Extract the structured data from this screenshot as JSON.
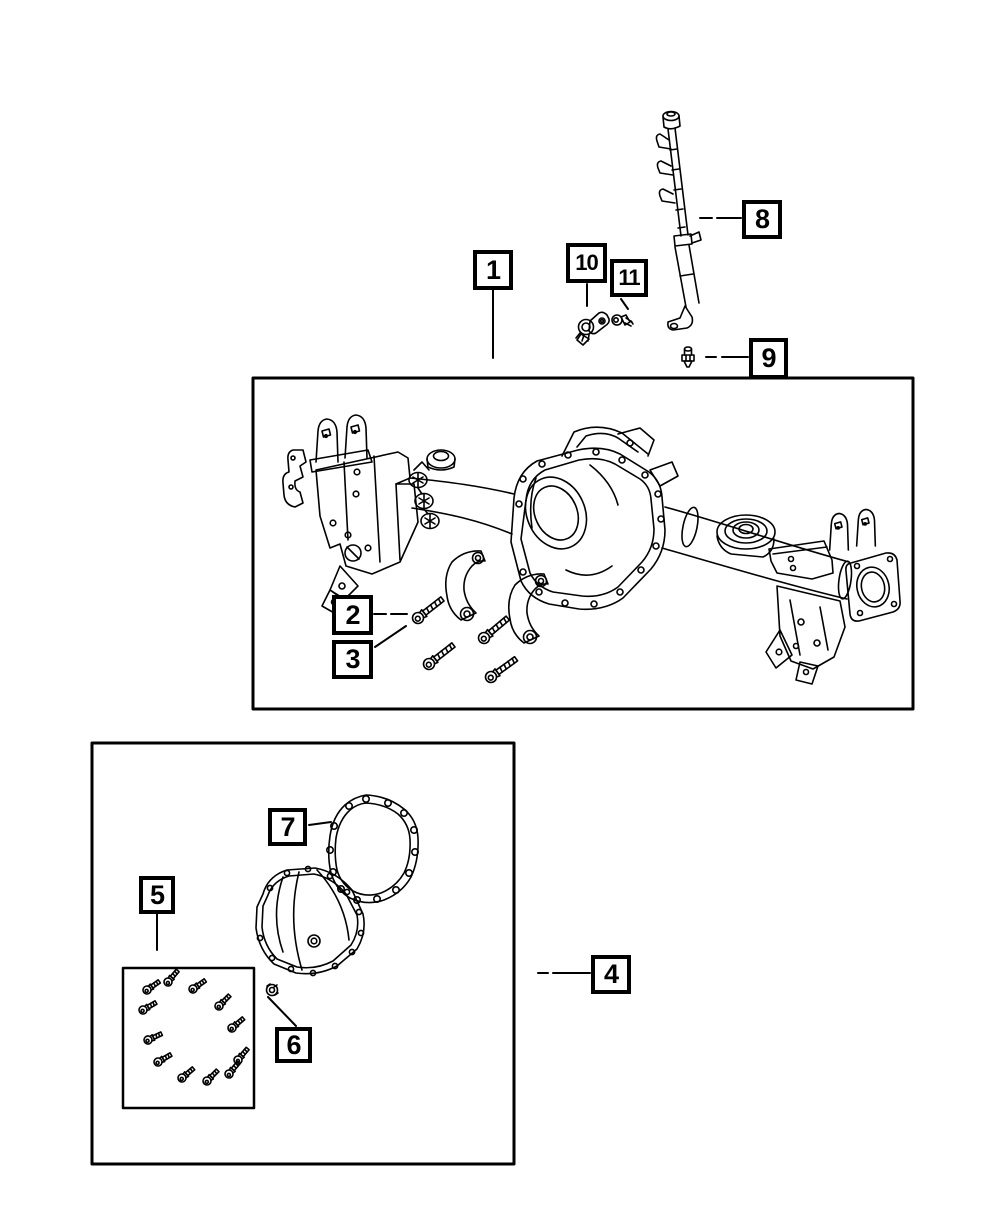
{
  "page": {
    "background_color": "#ffffff",
    "line_color": "#000000",
    "callout_border_color": "#000000",
    "callout_fill_color": "#ffffff"
  },
  "callouts": [
    {
      "label": "1",
      "icon": "axle-housing-assembly-drawing"
    },
    {
      "label": "2",
      "icon": "bracket-bolt-drawing"
    },
    {
      "label": "3",
      "icon": "control-arm-bracket-drawing"
    },
    {
      "label": "4",
      "icon": "differential-cover-panel"
    },
    {
      "label": "5",
      "icon": "cover-bolt-kit-drawing"
    },
    {
      "label": "6",
      "icon": "cover-nut-drawing"
    },
    {
      "label": "7",
      "icon": "cover-gasket-drawing"
    },
    {
      "label": "8",
      "icon": "axle-vent-hose-drawing"
    },
    {
      "label": "9",
      "icon": "vent-fitting-drawing"
    },
    {
      "label": "10",
      "icon": "speed-sensor-drawing"
    },
    {
      "label": "11",
      "icon": "sensor-screw-drawing"
    }
  ]
}
